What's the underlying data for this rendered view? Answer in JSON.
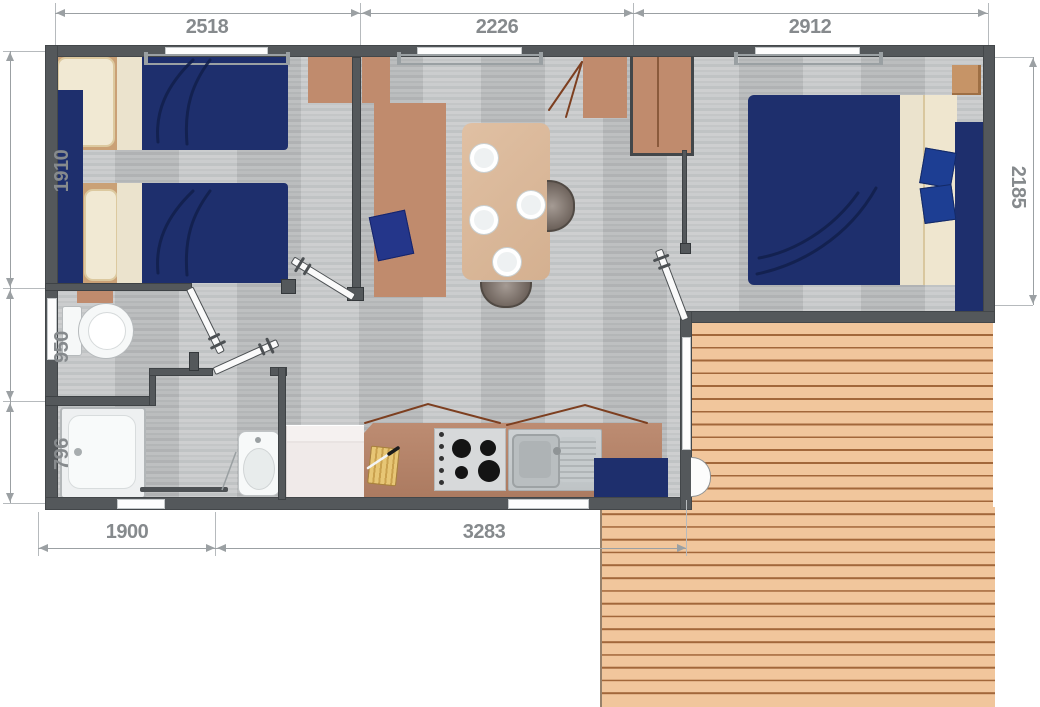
{
  "document": {
    "type": "mobile-home-floor-plan",
    "units": "mm"
  },
  "dimensions": {
    "top": [
      {
        "label": "2518"
      },
      {
        "label": "2226"
      },
      {
        "label": "2912"
      }
    ],
    "left": [
      {
        "label": "1910"
      },
      {
        "label": "950"
      },
      {
        "label": "796"
      }
    ],
    "bottom": [
      {
        "label": "1900"
      },
      {
        "label": "3283"
      }
    ],
    "right": [
      {
        "label": "2185"
      }
    ]
  },
  "palette": {
    "wall": "#54585b",
    "floor_gray": "#c2c4c5",
    "bedding_navy": "#1e2f6d",
    "pillow_cream": "#f1e9d3",
    "furniture_wood": "#c08b6d",
    "counter_wood": "#b5836b",
    "table_wood": "#dcbc9e",
    "deck_plank": "#f1c69c",
    "deck_line": "#a2673a",
    "dimension_text": "#868a8d",
    "dimension_line": "#9ba0a3"
  },
  "furniture_icons": [
    "twin-bed-icon",
    "twin-bed-icon",
    "wardrobe-icon",
    "bench-sofa-icon",
    "dining-table-icon",
    "plate-icon",
    "chair-icon",
    "double-bed-icon",
    "nightstand-icon",
    "kitchen-counter-icon",
    "hob-icon",
    "sink-icon",
    "fridge-icon",
    "toilet-icon",
    "shower-icon",
    "washbasin-icon",
    "door-leaf-icon",
    "deck-icon"
  ]
}
